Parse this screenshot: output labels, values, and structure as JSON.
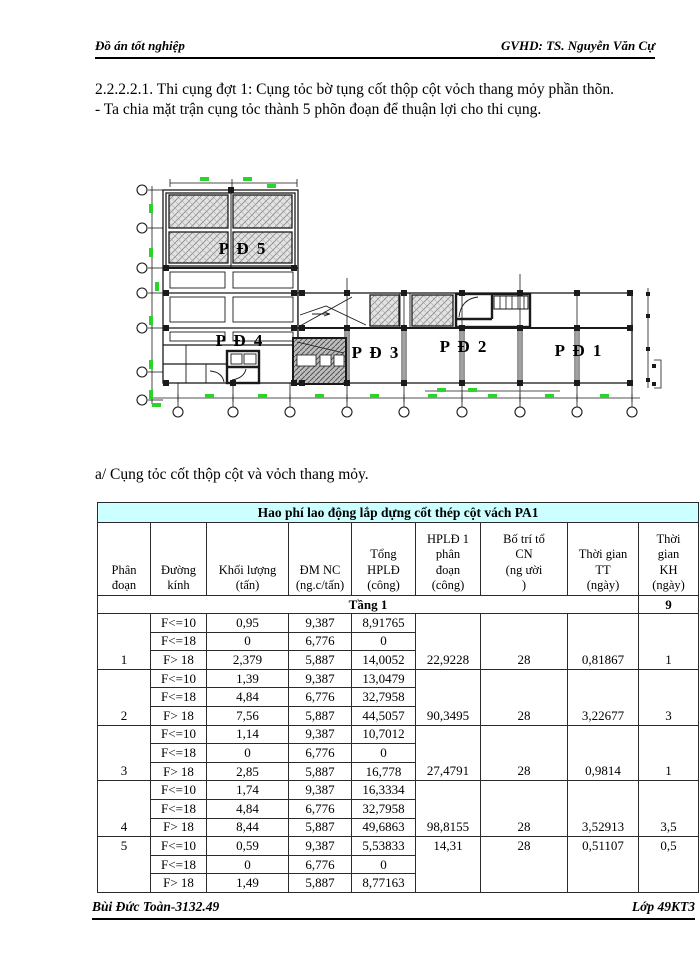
{
  "header": {
    "left": "Đồ án tốt nghiệp",
    "right": "GVHD: TS. Nguyễn Văn Cự"
  },
  "body": {
    "heading": "2.2.2.2.1. Thi cụng đợt 1: Cụng tỏc bờ tụng cốt thộp cột vỏch thang mỏy phần thõn.",
    "bullet": "- Ta chia mặt trận cụng tỏc thành 5 phõn đoạn để thuận lợi cho thi cụng.",
    "section_a": "a/ Cụng tỏc cốt thộp cột và vỏch thang mỏy."
  },
  "drawing": {
    "zones": {
      "pd5": "P Đ 5",
      "pd4": "P Đ 4",
      "pd3": "P Đ 3",
      "pd2": "P Đ 2",
      "pd1": "P Đ 1"
    },
    "accent_green": "#2bd42b",
    "line_color": "#1a1a1a"
  },
  "table": {
    "title": "Hao phí lao động lắp dựng cốt thép cột vách PA1",
    "header_bg": "#CCFFFF",
    "col_headers": [
      "Phân\nđoạn",
      "Đường\nkính",
      "Khối lượng\n(tấn)",
      "ĐM NC\n(ng.c/tấn)",
      "Tổng\nHPLĐ\n(công)",
      "HPLĐ 1\nphân\nđoạn\n(công)",
      "Bố trí tổ\nCN\n(ng ười\n)",
      "Thời gian\nTT\n(ngày)",
      "Thời\ngian\nKH\n(ngày)"
    ],
    "tang_label": "Tầng 1",
    "tang_kh": "9",
    "groups": [
      {
        "seg": "1",
        "valign": "bottom",
        "rows": [
          [
            "F<=10",
            "0,95",
            "9,387",
            "8,91765"
          ],
          [
            "F<=18",
            "0",
            "6,776",
            "0"
          ],
          [
            "F> 18",
            "2,379",
            "5,887",
            "14,0052"
          ]
        ],
        "hpld": "22,9228",
        "cn": "28",
        "tt": "0,81867",
        "kh": "1"
      },
      {
        "seg": "2",
        "valign": "bottom",
        "rows": [
          [
            "F<=10",
            "1,39",
            "9,387",
            "13,0479"
          ],
          [
            "F<=18",
            "4,84",
            "6,776",
            "32,7958"
          ],
          [
            "F> 18",
            "7,56",
            "5,887",
            "44,5057"
          ]
        ],
        "hpld": "90,3495",
        "cn": "28",
        "tt": "3,22677",
        "kh": "3"
      },
      {
        "seg": "3",
        "valign": "bottom",
        "rows": [
          [
            "F<=10",
            "1,14",
            "9,387",
            "10,7012"
          ],
          [
            "F<=18",
            "0",
            "6,776",
            "0"
          ],
          [
            "F> 18",
            "2,85",
            "5,887",
            "16,778"
          ]
        ],
        "hpld": "27,4791",
        "cn": "28",
        "tt": "0,9814",
        "kh": "1"
      },
      {
        "seg": "4",
        "valign": "bottom",
        "rows": [
          [
            "F<=10",
            "1,74",
            "9,387",
            "16,3334"
          ],
          [
            "F<=18",
            "4,84",
            "6,776",
            "32,7958"
          ],
          [
            "F> 18",
            "8,44",
            "5,887",
            "49,6863"
          ]
        ],
        "hpld": "98,8155",
        "cn": "28",
        "tt": "3,52913",
        "kh": "3,5"
      },
      {
        "seg": "5",
        "valign": "top",
        "rows": [
          [
            "F<=10",
            "0,59",
            "9,387",
            "5,53833"
          ],
          [
            "F<=18",
            "0",
            "6,776",
            "0"
          ],
          [
            "F> 18",
            "1,49",
            "5,887",
            "8,77163"
          ]
        ],
        "hpld": "14,31",
        "cn": "28",
        "tt": "0,51107",
        "kh": "0,5"
      }
    ]
  },
  "footer": {
    "left": "Bùi Đức Toàn-3132.49",
    "right": "Lớp 49KT3"
  }
}
